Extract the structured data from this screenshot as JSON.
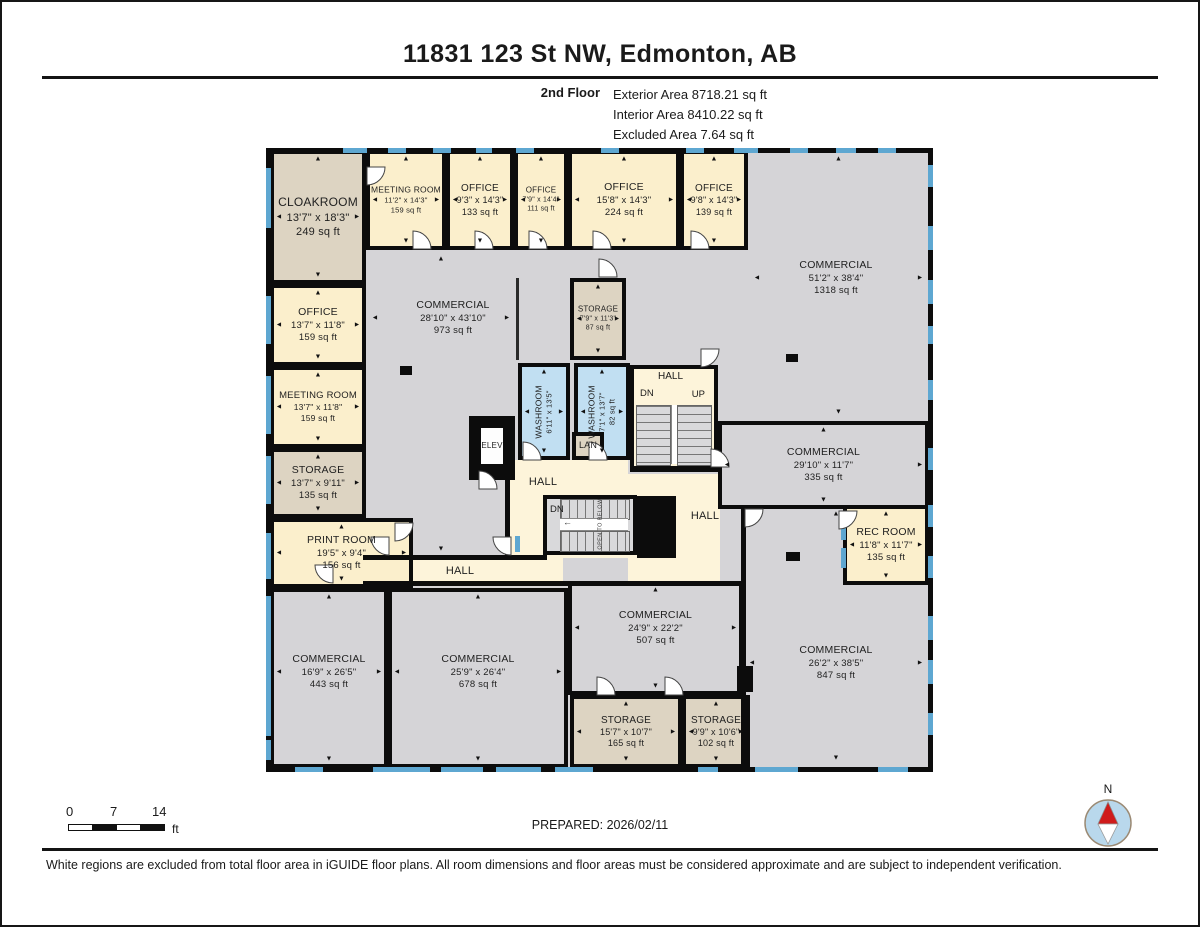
{
  "header": {
    "title": "11831 123 St NW, Edmonton, AB",
    "floor_label": "2nd Floor",
    "stats": [
      "Exterior Area 8718.21 sq ft",
      "Interior Area 8410.22 sq ft",
      "Excluded Area 7.64 sq ft"
    ]
  },
  "footer": {
    "prepared": "PREPARED: 2026/02/11",
    "disclaimer": "White regions are excluded from total floor area in iGUIDE floor plans. All room dimensions and floor areas must be considered approximate and are subject to independent verification.",
    "scale": {
      "labels": [
        "0",
        "7",
        "14"
      ],
      "unit": "ft"
    },
    "compass_label": "N"
  },
  "plan": {
    "colors": {
      "gray": "#d5d4d7",
      "cream": "#fbefcc",
      "hall": "#fdf4da",
      "tan": "#ddd4c2",
      "blue": "#c1dff2",
      "white": "#fdfdfd",
      "window": "#5ea7d1",
      "wall": "#0c0c0c",
      "compass_red": "#cf1b1b",
      "compass_fill": "#b9d8ec"
    },
    "stairs": {
      "upper": {
        "hall": "HALL",
        "dn": "DN",
        "up": "UP",
        "open": "OPEN TO BELOW"
      },
      "lower": {
        "dn": "DN",
        "open": "OPEN TO BELOW",
        "arrow": "←"
      }
    },
    "halls": [
      {
        "label": "HALL",
        "x": 244,
        "y": 312,
        "w": 118,
        "h": 98,
        "lx": 277,
        "ly": 334
      },
      {
        "label": "HALL",
        "x": 99,
        "y": 410,
        "w": 198,
        "h": 27,
        "lx": 194,
        "ly": 423
      },
      {
        "label": "HALL",
        "x": 352,
        "y": 326,
        "w": 102,
        "h": 81,
        "lx": 439,
        "ly": 368
      },
      {
        "x": 362,
        "y": 407,
        "w": 92,
        "h": 26
      }
    ],
    "rooms": [
      {
        "id": "cloakroom",
        "label": "CLOAKROOM",
        "dims": "13'7\" x 18'3\"",
        "area": "249 sq ft",
        "x": 4,
        "y": 2,
        "w": 96,
        "h": 134,
        "fill": "tan",
        "fs": 12
      },
      {
        "id": "meeting-room-a",
        "label": "MEETING ROOM",
        "dims": "11'2\" x 14'3\"",
        "area": "159 sq ft",
        "x": 100,
        "y": 2,
        "w": 80,
        "h": 100,
        "fill": "cream",
        "fs": 8.5
      },
      {
        "id": "office-133",
        "label": "OFFICE",
        "dims": "9'3\" x 14'3\"",
        "area": "133 sq ft",
        "x": 180,
        "y": 2,
        "w": 68,
        "h": 100,
        "fill": "cream",
        "fs": 10
      },
      {
        "id": "office-111",
        "label": "OFFICE",
        "dims": "7'9\" x 14'4\"",
        "area": "111 sq ft",
        "x": 248,
        "y": 2,
        "w": 54,
        "h": 100,
        "fill": "cream",
        "fs": 8
      },
      {
        "id": "office-224",
        "label": "OFFICE",
        "dims": "15'8\" x 14'3\"",
        "area": "224 sq ft",
        "x": 302,
        "y": 2,
        "w": 112,
        "h": 100,
        "fill": "cream",
        "fs": 10.5
      },
      {
        "id": "office-139",
        "label": "OFFICE",
        "dims": "9'8\" x 14'3\"",
        "area": "139 sq ft",
        "x": 414,
        "y": 2,
        "w": 68,
        "h": 100,
        "fill": "cream",
        "fs": 10
      },
      {
        "id": "office-159",
        "label": "OFFICE",
        "dims": "13'7\" x 11'8\"",
        "area": "159 sq ft",
        "x": 4,
        "y": 136,
        "w": 96,
        "h": 82,
        "fill": "cream",
        "fs": 10.5
      },
      {
        "id": "meeting-room-b",
        "label": "MEETING ROOM",
        "dims": "13'7\" x 11'8\"",
        "area": "159 sq ft",
        "x": 4,
        "y": 218,
        "w": 96,
        "h": 82,
        "fill": "cream",
        "fs": 9.5
      },
      {
        "id": "storage-135",
        "label": "STORAGE",
        "dims": "13'7\" x 9'11\"",
        "area": "135 sq ft",
        "x": 4,
        "y": 300,
        "w": 96,
        "h": 70,
        "fill": "tan",
        "fs": 10.5
      },
      {
        "id": "print-room",
        "label": "PRINT ROOM",
        "dims": "19'5\" x 9'4\"",
        "area": "156 sq ft",
        "x": 4,
        "y": 370,
        "w": 143,
        "h": 70,
        "fill": "cream",
        "fs": 10.5
      },
      {
        "id": "storage-87",
        "label": "STORAGE",
        "dims": "7'9\" x 11'3\"",
        "area": "87 sq ft",
        "x": 304,
        "y": 130,
        "w": 56,
        "h": 82,
        "fill": "tan",
        "fs": 8
      },
      {
        "id": "washroom-a",
        "label": "WASHROOM",
        "dims": "6'11\" x 13'5\"",
        "x": 252,
        "y": 215,
        "w": 52,
        "h": 97,
        "fill": "blue",
        "fs": 8.5,
        "vertical": true
      },
      {
        "id": "washroom-b",
        "label": "WASHROOM",
        "dims": "7'1\" x 13'7\"",
        "area": "82 sq ft",
        "x": 308,
        "y": 215,
        "w": 56,
        "h": 97,
        "fill": "blue",
        "fs": 8.5,
        "vertical": true
      },
      {
        "id": "lan",
        "label": "LAN",
        "x": 306,
        "y": 284,
        "w": 32,
        "h": 28,
        "fill": "tan",
        "fs": 9,
        "arrows": false
      },
      {
        "id": "commercial-1318",
        "label": "COMMERCIAL",
        "dims": "51'2\" x 38'4\"",
        "area": "1318 sq ft",
        "x": 482,
        "y": 2,
        "w": 181,
        "h": 271,
        "fill": "none",
        "fs": 10.5,
        "lx": 570,
        "ly": 130
      },
      {
        "id": "commercial-973",
        "label": "COMMERCIAL",
        "dims": "28'10\" x 43'10\"",
        "area": "973 sq ft",
        "x": 100,
        "y": 102,
        "w": 150,
        "h": 308,
        "fill": "none",
        "fs": 10.5,
        "lx": 187,
        "ly": 170
      },
      {
        "id": "commercial-335",
        "label": "COMMERCIAL",
        "dims": "29'10\" x 11'7\"",
        "area": "335 sq ft",
        "x": 452,
        "y": 273,
        "w": 211,
        "h": 88,
        "fill": "gray",
        "fs": 10.5
      },
      {
        "id": "rec-room",
        "label": "REC ROOM",
        "dims": "11'8\" x 11'7\"",
        "area": "135 sq ft",
        "x": 577,
        "y": 357,
        "w": 86,
        "h": 80,
        "fill": "cream",
        "fs": 10.5
      },
      {
        "id": "commercial-847",
        "label": "COMMERCIAL",
        "dims": "26'2\" x 38'5\"",
        "area": "847 sq ft",
        "x": 477,
        "y": 357,
        "w": 186,
        "h": 262,
        "fill": "none",
        "fs": 10.5,
        "lx": 570,
        "ly": 515
      },
      {
        "id": "commercial-443",
        "label": "COMMERCIAL",
        "dims": "16'9\" x 26'5\"",
        "area": "443 sq ft",
        "x": 4,
        "y": 440,
        "w": 118,
        "h": 180,
        "fill": "gray",
        "fs": 10.5,
        "ly": 524
      },
      {
        "id": "commercial-678",
        "label": "COMMERCIAL",
        "dims": "25'9\" x 26'4\"",
        "area": "678 sq ft",
        "x": 122,
        "y": 440,
        "w": 180,
        "h": 180,
        "fill": "gray",
        "fs": 10.5,
        "ly": 524
      },
      {
        "id": "commercial-507",
        "label": "COMMERCIAL",
        "dims": "24'9\" x 22'2\"",
        "area": "507 sq ft",
        "x": 302,
        "y": 433,
        "w": 175,
        "h": 114,
        "fill": "gray",
        "fs": 10.5,
        "ly": 480
      },
      {
        "id": "storage-165",
        "label": "STORAGE",
        "dims": "15'7\" x 10'7\"",
        "area": "165 sq ft",
        "x": 304,
        "y": 547,
        "w": 112,
        "h": 73,
        "fill": "tan",
        "fs": 10
      },
      {
        "id": "storage-102",
        "label": "STORAGE",
        "dims": "9'9\" x 10'6\"",
        "area": "102 sq ft",
        "x": 416,
        "y": 547,
        "w": 68,
        "h": 73,
        "fill": "tan",
        "fs": 10
      },
      {
        "id": "elevator-cab",
        "label": "ELEV",
        "x": 211,
        "y": 276,
        "w": 30,
        "h": 44,
        "fill": "white",
        "fs": 8,
        "arrows": false,
        "z": 24
      }
    ],
    "walls": [
      [
        0,
        0,
        667,
        5
      ],
      [
        0,
        619,
        667,
        5
      ],
      [
        0,
        0,
        5,
        624
      ],
      [
        662,
        0,
        5,
        624
      ],
      [
        97,
        407,
        184,
        5
      ],
      [
        239,
        309,
        5,
        103
      ],
      [
        97,
        433,
        380,
        5
      ],
      [
        475,
        357,
        5,
        263
      ],
      [
        364,
        319,
        92,
        5
      ]
    ],
    "thin_walls": [
      [
        250,
        130,
        3,
        82
      ]
    ],
    "posts": [
      [
        134,
        218,
        12,
        9
      ],
      [
        520,
        404,
        14,
        9
      ],
      [
        520,
        206,
        12,
        8
      ],
      [
        471,
        518,
        16,
        26
      ],
      [
        371,
        348,
        39,
        62
      ],
      [
        203,
        268,
        46,
        64
      ]
    ],
    "windows": [
      [
        77,
        0,
        24,
        5
      ],
      [
        122,
        0,
        18,
        5
      ],
      [
        167,
        0,
        18,
        5
      ],
      [
        210,
        0,
        16,
        5
      ],
      [
        250,
        0,
        18,
        5
      ],
      [
        335,
        0,
        18,
        5
      ],
      [
        420,
        0,
        18,
        5
      ],
      [
        468,
        0,
        24,
        5
      ],
      [
        524,
        0,
        18,
        5
      ],
      [
        570,
        0,
        20,
        5
      ],
      [
        612,
        0,
        18,
        5
      ],
      [
        29,
        619,
        28,
        5
      ],
      [
        107,
        619,
        57,
        5
      ],
      [
        175,
        619,
        42,
        5
      ],
      [
        230,
        619,
        45,
        5
      ],
      [
        289,
        619,
        38,
        5
      ],
      [
        432,
        619,
        20,
        5
      ],
      [
        489,
        619,
        43,
        5
      ],
      [
        612,
        619,
        30,
        5
      ],
      [
        0,
        20,
        5,
        60
      ],
      [
        0,
        148,
        5,
        48
      ],
      [
        0,
        228,
        5,
        58
      ],
      [
        0,
        308,
        5,
        48
      ],
      [
        0,
        385,
        5,
        46
      ],
      [
        0,
        448,
        5,
        140
      ],
      [
        0,
        592,
        5,
        20
      ],
      [
        662,
        17,
        5,
        22
      ],
      [
        662,
        78,
        5,
        24
      ],
      [
        662,
        132,
        5,
        24
      ],
      [
        662,
        178,
        5,
        18
      ],
      [
        662,
        232,
        5,
        20
      ],
      [
        662,
        300,
        5,
        22
      ],
      [
        662,
        357,
        5,
        22
      ],
      [
        662,
        408,
        5,
        22
      ],
      [
        662,
        468,
        5,
        24
      ],
      [
        662,
        512,
        5,
        24
      ],
      [
        662,
        565,
        5,
        22
      ],
      [
        575,
        372,
        5,
        20
      ],
      [
        575,
        400,
        5,
        20
      ],
      [
        249,
        388,
        5,
        16
      ]
    ],
    "doors": [
      [
        100,
        18,
        90
      ],
      [
        146,
        82,
        0
      ],
      [
        208,
        82,
        0
      ],
      [
        262,
        82,
        0
      ],
      [
        326,
        82,
        0
      ],
      [
        424,
        82,
        0
      ],
      [
        332,
        110,
        0
      ],
      [
        256,
        293,
        0
      ],
      [
        322,
        293,
        0
      ],
      [
        212,
        322,
        0
      ],
      [
        434,
        200,
        90
      ],
      [
        128,
        374,
        90
      ],
      [
        104,
        388,
        180
      ],
      [
        226,
        388,
        180
      ],
      [
        572,
        362,
        90
      ],
      [
        478,
        360,
        90
      ],
      [
        330,
        528,
        0
      ],
      [
        398,
        528,
        0
      ],
      [
        48,
        416,
        180
      ],
      [
        444,
        300,
        0
      ]
    ]
  }
}
